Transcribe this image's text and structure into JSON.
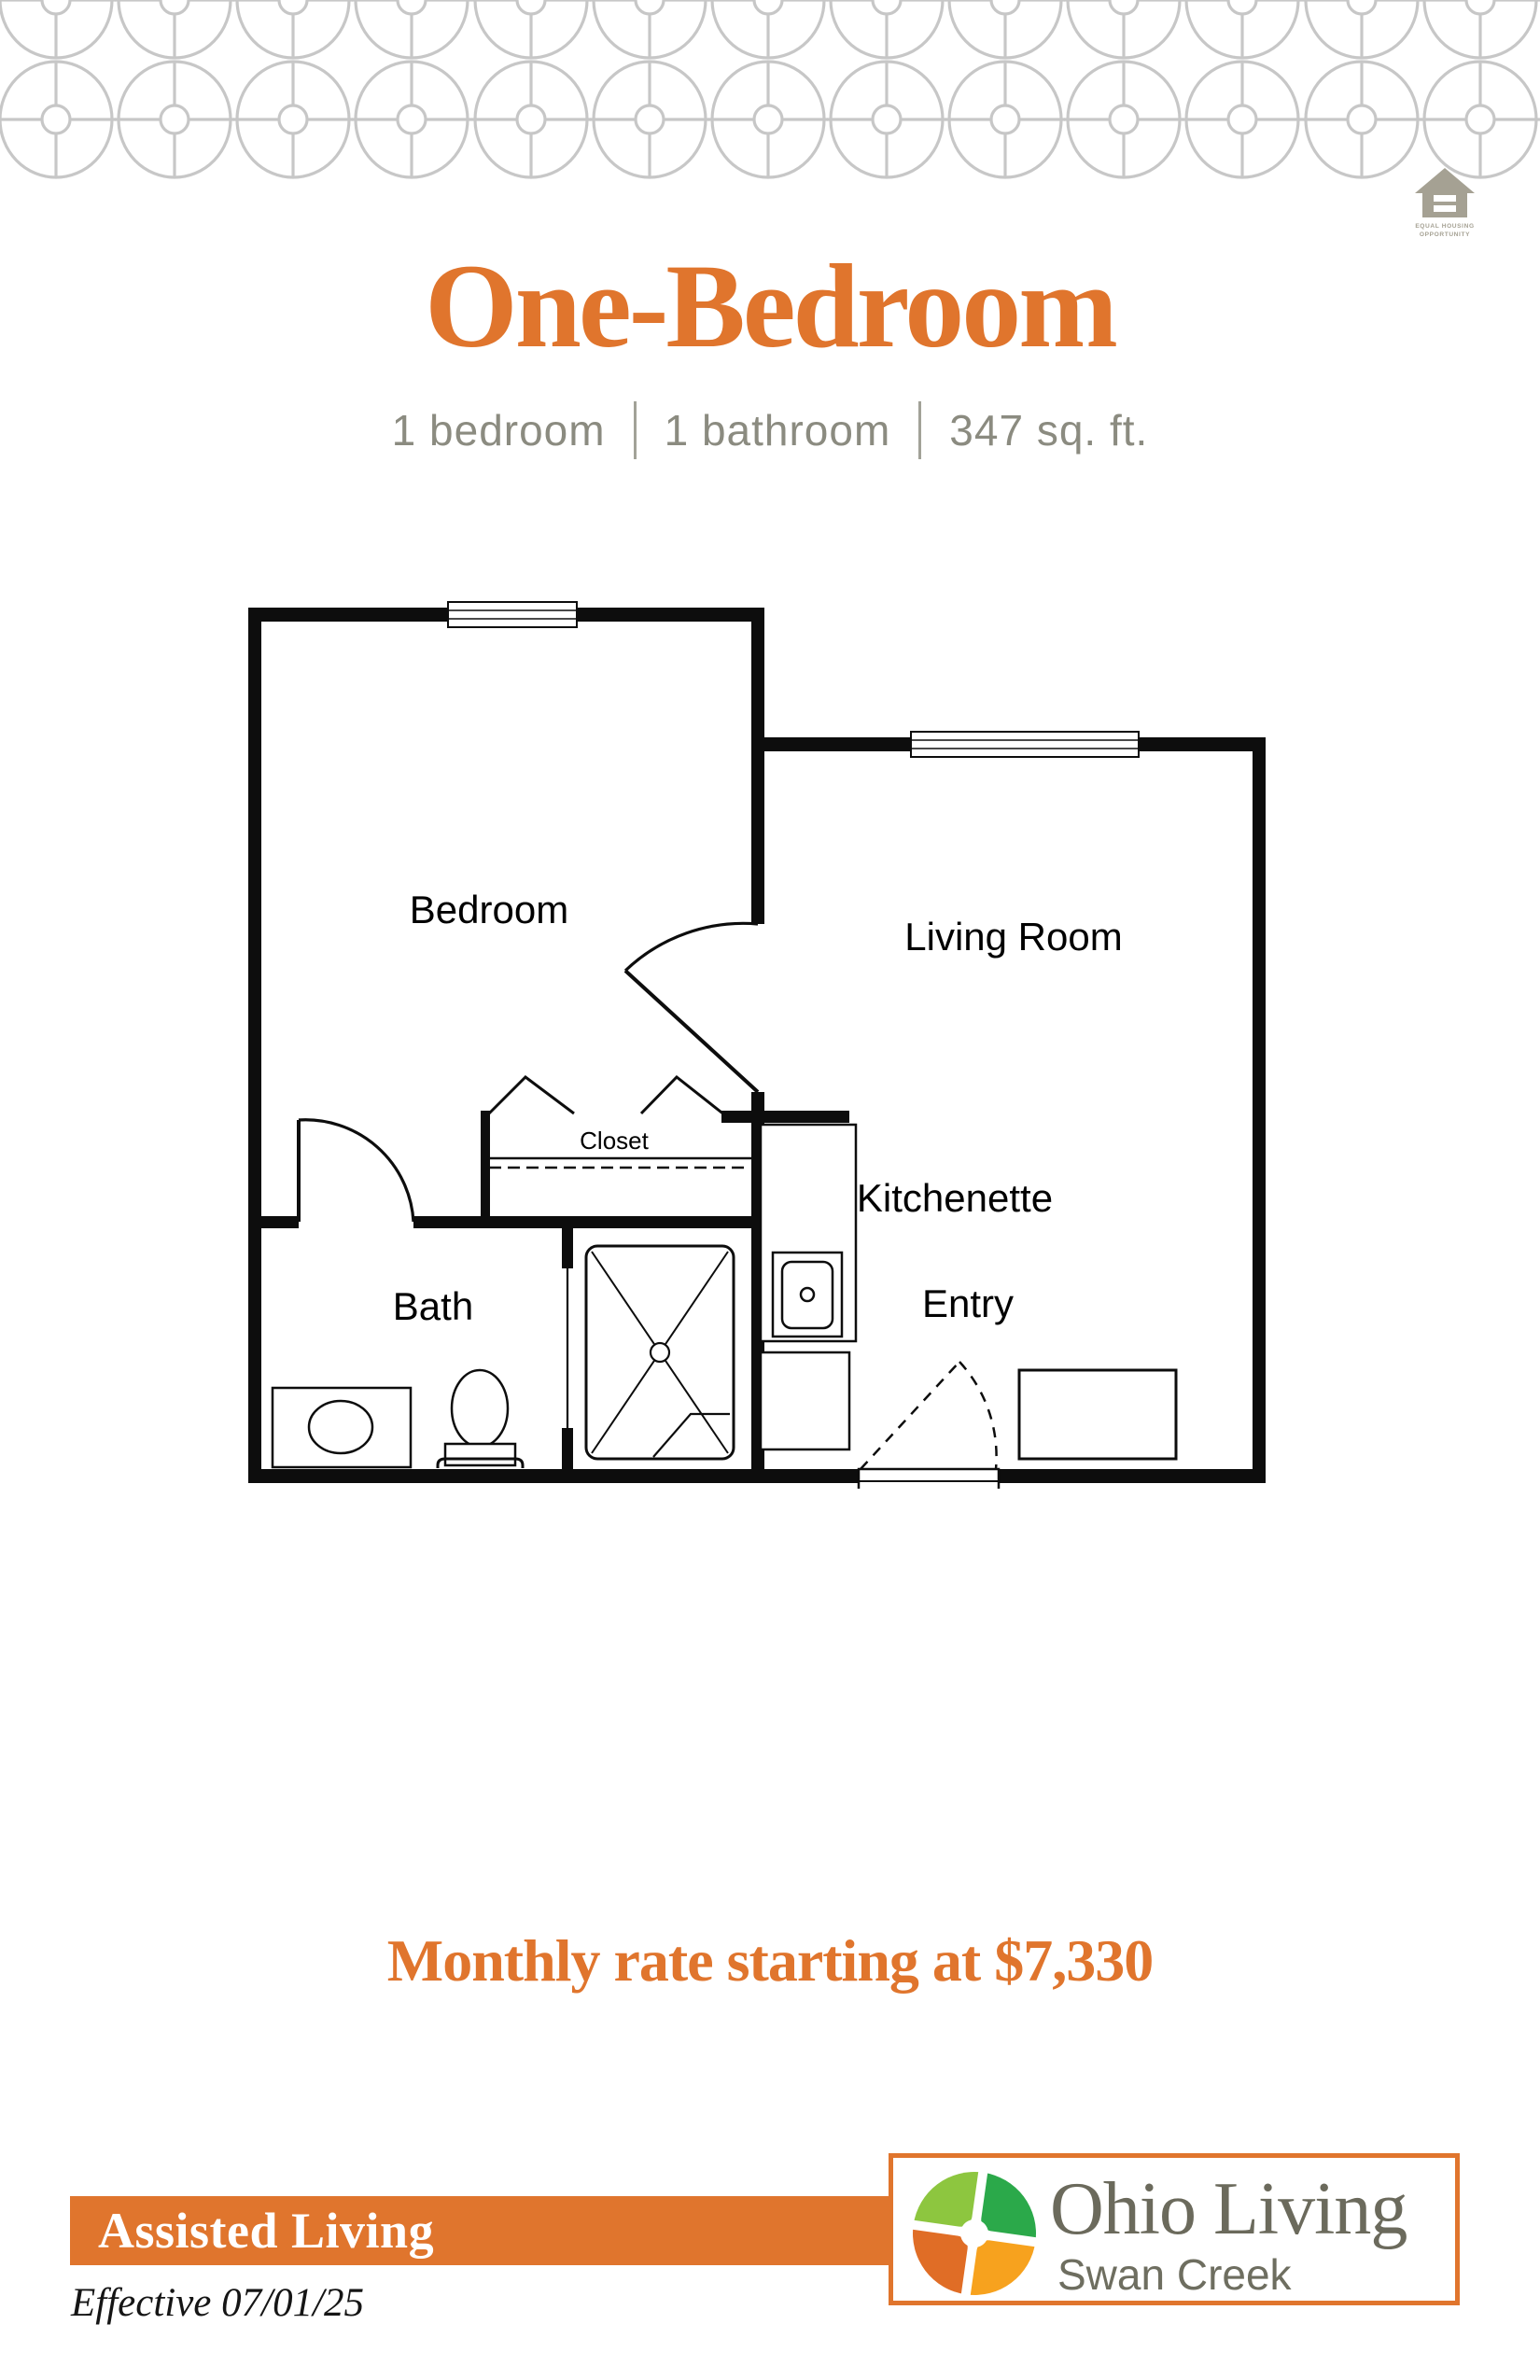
{
  "header": {
    "title": "One-Bedroom",
    "specs": [
      "1 bedroom",
      "1 bathroom",
      "347 sq. ft."
    ],
    "eho": {
      "line1": "EQUAL HOUSING",
      "line2": "OPPORTUNITY"
    }
  },
  "floorplan": {
    "labels": {
      "bedroom": "Bedroom",
      "living_room": "Living Room",
      "closet": "Closet",
      "kitchenette": "Kitchenette",
      "entry": "Entry",
      "bath": "Bath"
    }
  },
  "rate": {
    "text": "Monthly rate starting at $7,330"
  },
  "footer": {
    "care_level": "Assisted Living",
    "effective": "Effective 07/01/25",
    "brand": "Ohio Living",
    "community": "Swan Creek"
  },
  "colors": {
    "accent_orange": "#e0752d",
    "pattern_gray": "#c7c7c7",
    "spec_text_gray": "#8b8b80",
    "brand_text_gray": "#6b6a5c",
    "eho_gray": "#a5a193",
    "logo_quadrant_top_left": "#8dc63f",
    "logo_quadrant_top_right": "#2ba94a",
    "logo_quadrant_bottom_left": "#e06d26",
    "logo_quadrant_bottom_right": "#f7a21e"
  }
}
